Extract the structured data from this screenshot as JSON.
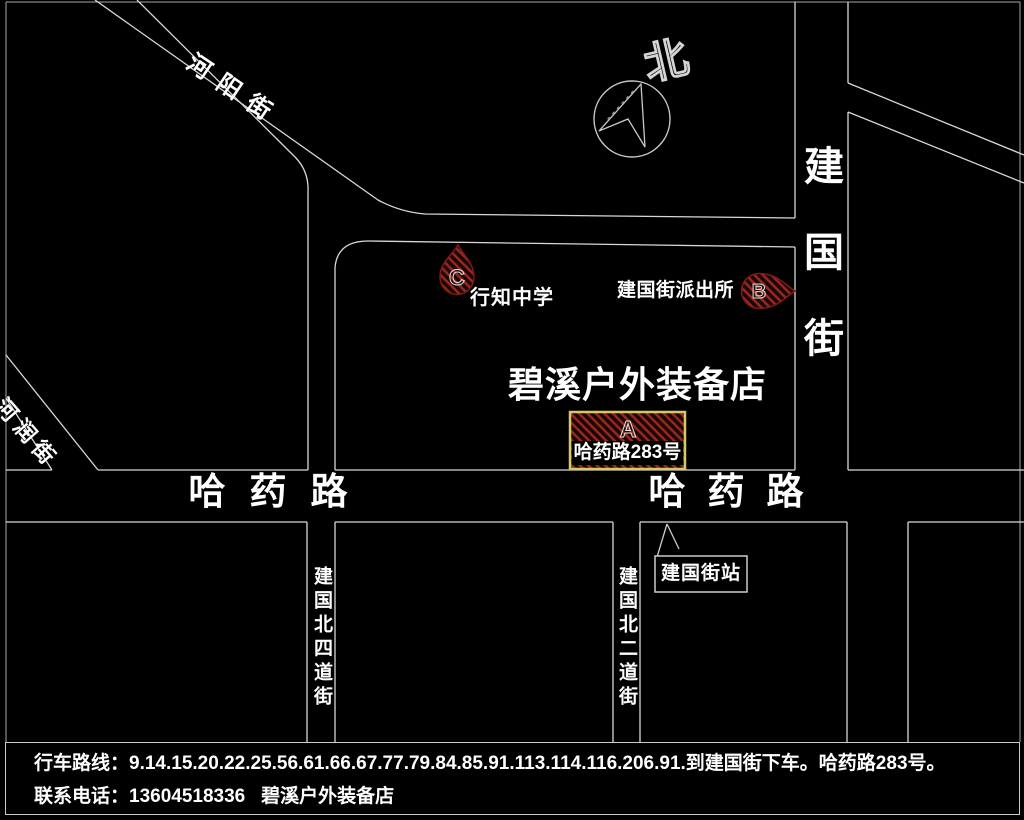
{
  "map": {
    "compass_label": "北",
    "streets": {
      "heyang": "河阳街",
      "herun": "河润街",
      "jianguo_vertical": "建国街",
      "hayao_left": "哈药路",
      "hayao_right": "哈药路",
      "jianguo_north4": "建国北四道街",
      "jianguo_north2": "建国北二道街"
    },
    "store_name": "碧溪户外装备店",
    "markers": {
      "a": {
        "letter": "A",
        "label": "哈药路283号"
      },
      "b": {
        "letter": "B",
        "label": "建国街派出所"
      },
      "c": {
        "letter": "C",
        "label": "行知中学"
      }
    },
    "bus_stop_label": "建国街站"
  },
  "footer": {
    "route_line": "行车路线：9.14.15.20.22.25.56.61.66.67.77.79.84.85.91.113.114.116.206.91.到建国街下车。哈药路283号。",
    "contact_line": "联系电话：13604518336   碧溪户外装备店"
  },
  "colors": {
    "background": "#000000",
    "road_line": "#d8d8d8",
    "text": "#ffffff",
    "marker_hatch_stripe": "#97291f",
    "marker_hatch_base": "#1d0505",
    "marker_outline": "#7d1b15",
    "address_box_border": "#d8c76a"
  }
}
